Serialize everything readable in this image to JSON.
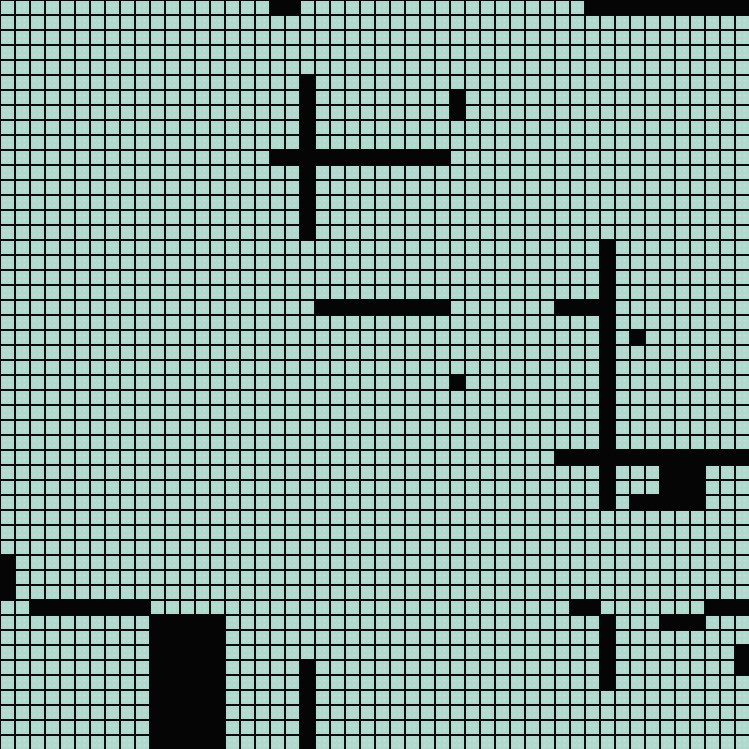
{
  "grid": {
    "columns": 50,
    "rows": 50,
    "cell_size_px": 15,
    "colors": {
      "background": "#b0d8cc",
      "grid_line": "#0a0a0a",
      "wall": "#050505"
    },
    "wall_rects": [
      {
        "col": 18,
        "row": 0,
        "w": 2,
        "h": 1
      },
      {
        "col": 39,
        "row": 0,
        "w": 11,
        "h": 1
      },
      {
        "col": 20,
        "row": 5,
        "w": 1,
        "h": 11
      },
      {
        "col": 18,
        "row": 10,
        "w": 12,
        "h": 1
      },
      {
        "col": 30,
        "row": 6,
        "w": 1,
        "h": 2
      },
      {
        "col": 21,
        "row": 20,
        "w": 9,
        "h": 1
      },
      {
        "col": 37,
        "row": 20,
        "w": 3,
        "h": 1
      },
      {
        "col": 40,
        "row": 16,
        "w": 1,
        "h": 18
      },
      {
        "col": 42,
        "row": 22,
        "w": 1,
        "h": 1
      },
      {
        "col": 30,
        "row": 25,
        "w": 1,
        "h": 1
      },
      {
        "col": 37,
        "row": 30,
        "w": 13,
        "h": 1
      },
      {
        "col": 44,
        "row": 31,
        "w": 3,
        "h": 3
      },
      {
        "col": 42,
        "row": 33,
        "w": 2,
        "h": 1
      },
      {
        "col": 0,
        "row": 37,
        "w": 1,
        "h": 3
      },
      {
        "col": 2,
        "row": 40,
        "w": 8,
        "h": 1
      },
      {
        "col": 10,
        "row": 41,
        "w": 5,
        "h": 9
      },
      {
        "col": 20,
        "row": 44,
        "w": 1,
        "h": 6
      },
      {
        "col": 38,
        "row": 40,
        "w": 2,
        "h": 1
      },
      {
        "col": 47,
        "row": 40,
        "w": 3,
        "h": 1
      },
      {
        "col": 40,
        "row": 41,
        "w": 1,
        "h": 5
      },
      {
        "col": 44,
        "row": 41,
        "w": 3,
        "h": 1
      },
      {
        "col": 49,
        "row": 43,
        "w": 1,
        "h": 2
      }
    ]
  }
}
